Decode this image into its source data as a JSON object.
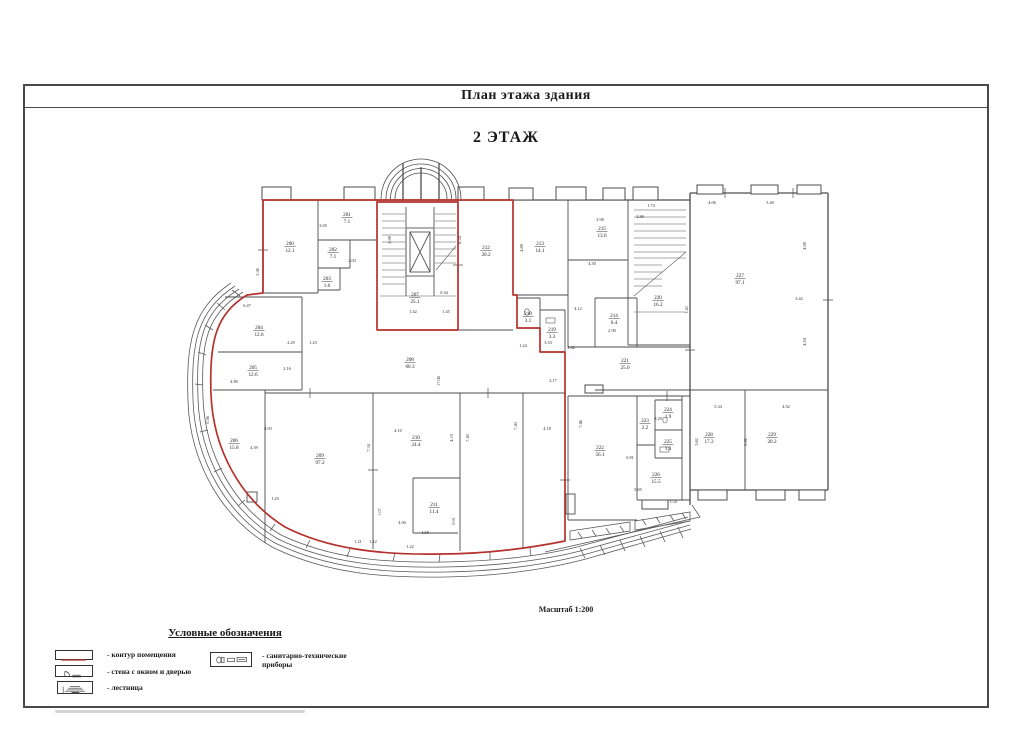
{
  "page": {
    "title": "План этажа здания",
    "floor_label": "2 ЭТАЖ",
    "scale_label": "Масштаб 1:200"
  },
  "legend": {
    "title": "Условные обозначения",
    "items": [
      {
        "icon": "room-contour-icon",
        "label": "- контур помещения"
      },
      {
        "icon": "wall-window-door-icon",
        "label": "- стена с окном и дверью"
      },
      {
        "icon": "stairs-icon",
        "label": "- лестница"
      },
      {
        "icon": "sanitary-icon",
        "label": "- санитарно-технические приборы"
      }
    ]
  },
  "colors": {
    "contour_red": "#b5312c",
    "wall_gray": "#4d4d4d",
    "text": "#222222"
  },
  "rooms": [
    {
      "n": "200",
      "a": "12.1",
      "x": 290,
      "y": 245
    },
    {
      "n": "201",
      "a": "7.1",
      "x": 347,
      "y": 216
    },
    {
      "n": "202",
      "a": "7.1",
      "x": 333,
      "y": 251
    },
    {
      "n": "203",
      "a": "1.6",
      "x": 327,
      "y": 280
    },
    {
      "n": "204",
      "a": "12.6",
      "x": 259,
      "y": 329
    },
    {
      "n": "205",
      "a": "12.6",
      "x": 253,
      "y": 369
    },
    {
      "n": "206",
      "a": "15.8",
      "x": 234,
      "y": 442
    },
    {
      "n": "207",
      "a": "25.1",
      "x": 415,
      "y": 296
    },
    {
      "n": "208",
      "a": "60.3",
      "x": 410,
      "y": 361
    },
    {
      "n": "209",
      "a": "97.2",
      "x": 320,
      "y": 457
    },
    {
      "n": "210",
      "a": "24.4",
      "x": 416,
      "y": 439
    },
    {
      "n": "211",
      "a": "11.4",
      "x": 434,
      "y": 506
    },
    {
      "n": "212",
      "a": "20.2",
      "x": 486,
      "y": 249
    },
    {
      "n": "213",
      "a": "14.1",
      "x": 540,
      "y": 245
    },
    {
      "n": "215",
      "a": "13.6",
      "x": 602,
      "y": 230
    },
    {
      "n": "214",
      "a": "6.4",
      "x": 614,
      "y": 317
    },
    {
      "n": "218",
      "a": "3.1",
      "x": 528,
      "y": 315
    },
    {
      "n": "219",
      "a": "3.3",
      "x": 552,
      "y": 331
    },
    {
      "n": "220",
      "a": "16.2",
      "x": 658,
      "y": 299
    },
    {
      "n": "221",
      "a": "25.0",
      "x": 625,
      "y": 362
    },
    {
      "n": "222",
      "a": "56.1",
      "x": 600,
      "y": 449
    },
    {
      "n": "223",
      "a": "2.2",
      "x": 645,
      "y": 422
    },
    {
      "n": "224",
      "a": "1.9",
      "x": 668,
      "y": 411
    },
    {
      "n": "225",
      "a": "1.9",
      "x": 668,
      "y": 443
    },
    {
      "n": "226",
      "a": "15.5",
      "x": 656,
      "y": 476
    },
    {
      "n": "227",
      "a": "97.1",
      "x": 740,
      "y": 277
    },
    {
      "n": "228",
      "a": "17.2",
      "x": 709,
      "y": 436
    },
    {
      "n": "229",
      "a": "20.2",
      "x": 772,
      "y": 436
    }
  ],
  "dims": [
    {
      "t": "3.05",
      "x": 323,
      "y": 227,
      "r": 0
    },
    {
      "t": "2.03",
      "x": 352,
      "y": 262,
      "r": 0
    },
    {
      "t": "5.36",
      "x": 259,
      "y": 272,
      "r": -90
    },
    {
      "t": "6.47",
      "x": 247,
      "y": 307,
      "r": 0
    },
    {
      "t": "2.29",
      "x": 291,
      "y": 344,
      "r": 0
    },
    {
      "t": "1.23",
      "x": 313,
      "y": 344,
      "r": 0
    },
    {
      "t": "2.16",
      "x": 287,
      "y": 370,
      "r": 0
    },
    {
      "t": "4.80",
      "x": 234,
      "y": 383,
      "r": 0
    },
    {
      "t": "0.56",
      "x": 209,
      "y": 420,
      "r": -90
    },
    {
      "t": "4.93",
      "x": 268,
      "y": 430,
      "r": 0
    },
    {
      "t": "4.39",
      "x": 254,
      "y": 449,
      "r": 0
    },
    {
      "t": "7.34",
      "x": 370,
      "y": 448,
      "r": -90
    },
    {
      "t": "4.10",
      "x": 398,
      "y": 432,
      "r": 0
    },
    {
      "t": "4.19",
      "x": 453,
      "y": 438,
      "r": -90
    },
    {
      "t": "7.40",
      "x": 469,
      "y": 438,
      "r": -90
    },
    {
      "t": "7.40",
      "x": 517,
      "y": 426,
      "r": -90
    },
    {
      "t": "4.18",
      "x": 547,
      "y": 430,
      "r": 0
    },
    {
      "t": "7.46",
      "x": 582,
      "y": 424,
      "r": -90
    },
    {
      "t": "17.06",
      "x": 440,
      "y": 381,
      "r": -90
    },
    {
      "t": "2.17",
      "x": 553,
      "y": 382,
      "r": 0
    },
    {
      "t": "1.25",
      "x": 275,
      "y": 500,
      "r": 0
    },
    {
      "t": "1.07",
      "x": 381,
      "y": 512,
      "r": -90
    },
    {
      "t": "4.06",
      "x": 402,
      "y": 524,
      "r": 0
    },
    {
      "t": "4.58",
      "x": 425,
      "y": 534,
      "r": 0
    },
    {
      "t": "0.91",
      "x": 455,
      "y": 521,
      "r": -90
    },
    {
      "t": "1.21",
      "x": 358,
      "y": 543,
      "r": 0
    },
    {
      "t": "1.12",
      "x": 373,
      "y": 543,
      "r": 0
    },
    {
      "t": "1.22",
      "x": 410,
      "y": 548,
      "r": 0
    },
    {
      "t": "5.05",
      "x": 638,
      "y": 491,
      "r": 0
    },
    {
      "t": "1.54",
      "x": 673,
      "y": 503,
      "r": 0
    },
    {
      "t": "0.81",
      "x": 630,
      "y": 459,
      "r": 0
    },
    {
      "t": "8.29",
      "x": 658,
      "y": 420,
      "r": 0
    },
    {
      "t": "1.24",
      "x": 523,
      "y": 347,
      "r": 0
    },
    {
      "t": "3.33",
      "x": 548,
      "y": 344,
      "r": 0
    },
    {
      "t": "4.62",
      "x": 571,
      "y": 349,
      "r": 0
    },
    {
      "t": "0.44",
      "x": 444,
      "y": 294,
      "r": 0
    },
    {
      "t": "1.42",
      "x": 413,
      "y": 313,
      "r": 0
    },
    {
      "t": "1.45",
      "x": 446,
      "y": 313,
      "r": 0
    },
    {
      "t": "6.34",
      "x": 461,
      "y": 240,
      "r": -90
    },
    {
      "t": "4.98",
      "x": 391,
      "y": 240,
      "r": -90
    },
    {
      "t": "4.88",
      "x": 523,
      "y": 248,
      "r": -90
    },
    {
      "t": "3.98",
      "x": 600,
      "y": 221,
      "r": 0
    },
    {
      "t": "4.12",
      "x": 578,
      "y": 310,
      "r": 0
    },
    {
      "t": "2.90",
      "x": 612,
      "y": 332,
      "r": 0
    },
    {
      "t": "2.86",
      "x": 640,
      "y": 218,
      "r": 0
    },
    {
      "t": "4.98",
      "x": 806,
      "y": 246,
      "r": -90
    },
    {
      "t": "3.42",
      "x": 799,
      "y": 300,
      "r": 0
    },
    {
      "t": "4.94",
      "x": 806,
      "y": 342,
      "r": -90
    },
    {
      "t": "4.06",
      "x": 712,
      "y": 204,
      "r": 0
    },
    {
      "t": "3.40",
      "x": 770,
      "y": 204,
      "r": 0
    },
    {
      "t": "5.34",
      "x": 718,
      "y": 408,
      "r": 0
    },
    {
      "t": "4.92",
      "x": 786,
      "y": 408,
      "r": 0
    },
    {
      "t": "0.92",
      "x": 747,
      "y": 442,
      "r": -90
    },
    {
      "t": "3.62",
      "x": 698,
      "y": 442,
      "r": -90
    },
    {
      "t": "1.43",
      "x": 688,
      "y": 310,
      "r": -90
    },
    {
      "t": "1.74",
      "x": 651,
      "y": 207,
      "r": 0
    },
    {
      "t": "4.50",
      "x": 592,
      "y": 265,
      "r": 0
    }
  ]
}
